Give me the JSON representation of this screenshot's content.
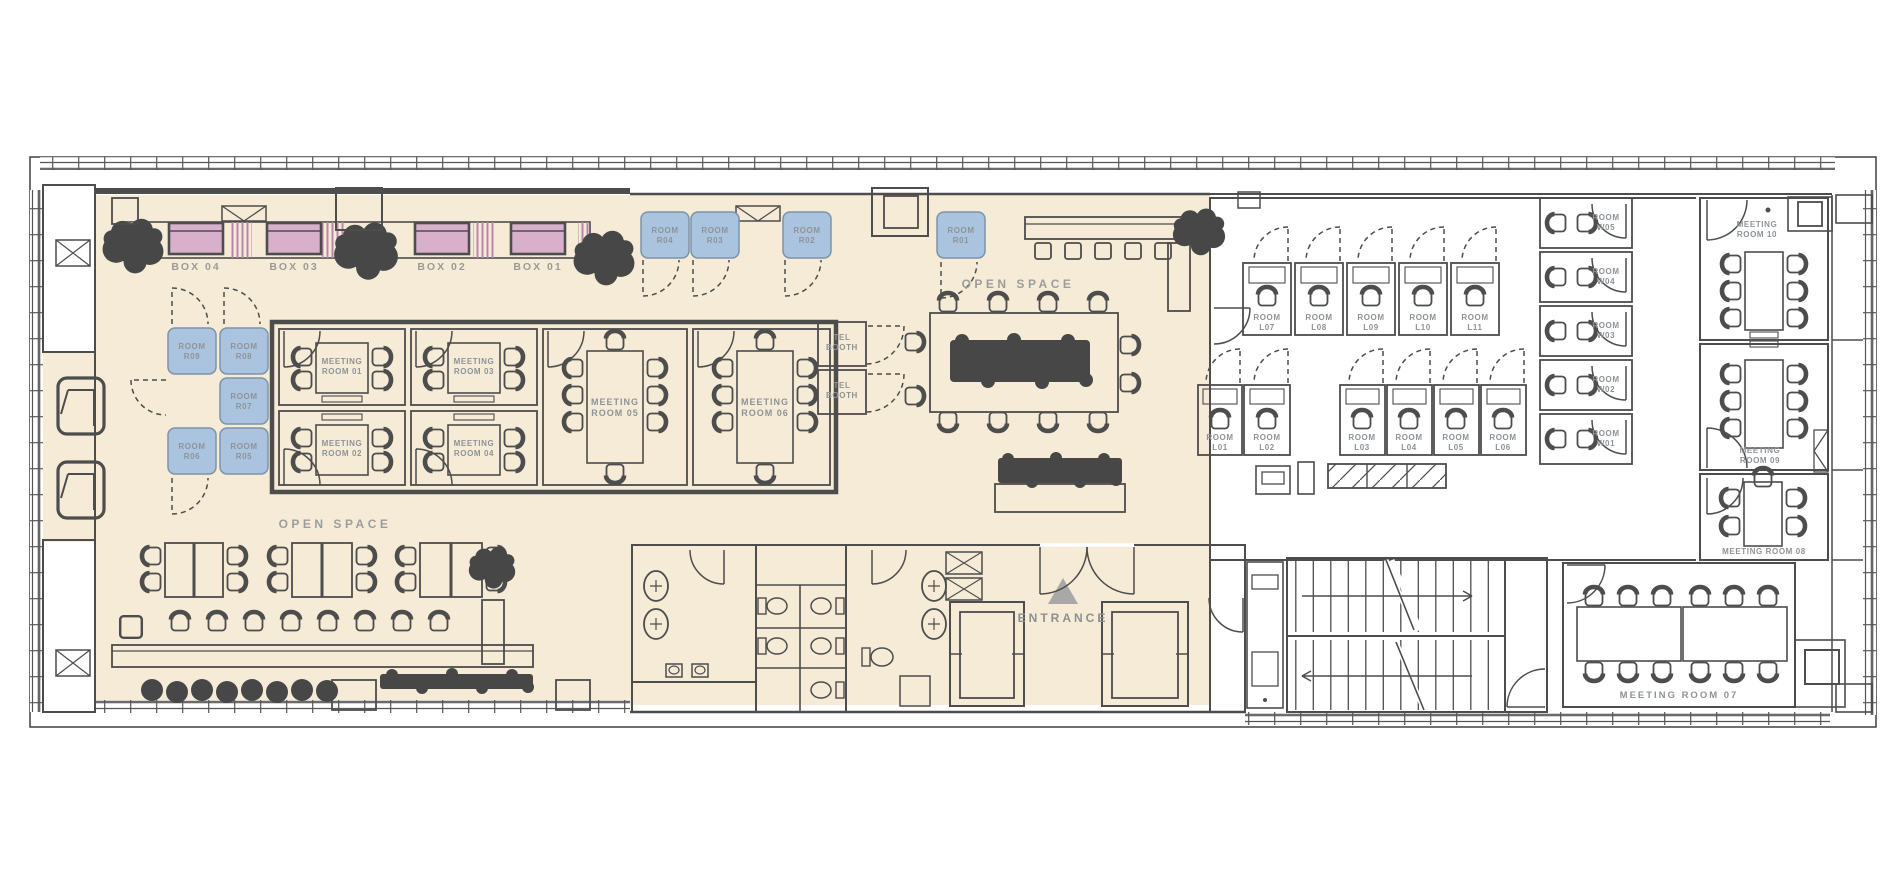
{
  "colors": {
    "floor_beige": "#f5ebd7",
    "room_blue": "#aac4e0",
    "room_blue_light": "#c6d8ec",
    "box_pink": "#d8b0cb",
    "box_pink_stripe": "#bb85ab",
    "zone_gray": "#e4e3e1",
    "booth_gray": "#e7e6e3",
    "wall": "#4d4d4d",
    "furniture": "#4a4a4a",
    "label_gray": "#9a9a9a",
    "entrance_marker": "#a8a8a8"
  },
  "boxes": [
    "BOX 04",
    "BOX 03",
    "BOX 02",
    "BOX 01"
  ],
  "open_space": {
    "center": "OPEN SPACE",
    "lounge": "OPEN SPACE"
  },
  "entrance": {
    "label": "ENTRANCE"
  },
  "tel_booths": [
    [
      "TEL",
      "BOOTH"
    ],
    [
      "TEL",
      "BOOTH"
    ]
  ],
  "rooms_r": [
    [
      "ROOM",
      "R01"
    ],
    [
      "ROOM",
      "R02"
    ],
    [
      "ROOM",
      "R03"
    ],
    [
      "ROOM",
      "R04"
    ],
    [
      "ROOM",
      "R05"
    ],
    [
      "ROOM",
      "R06"
    ],
    [
      "ROOM",
      "R07"
    ],
    [
      "ROOM",
      "R08"
    ],
    [
      "ROOM",
      "R09"
    ]
  ],
  "rooms_l": [
    [
      "ROOM",
      "L01"
    ],
    [
      "ROOM",
      "L02"
    ],
    [
      "ROOM",
      "L03"
    ],
    [
      "ROOM",
      "L04"
    ],
    [
      "ROOM",
      "L05"
    ],
    [
      "ROOM",
      "L06"
    ],
    [
      "ROOM",
      "L07"
    ],
    [
      "ROOM",
      "L08"
    ],
    [
      "ROOM",
      "L09"
    ],
    [
      "ROOM",
      "L10"
    ],
    [
      "ROOM",
      "L11"
    ]
  ],
  "rooms_w": [
    [
      "ROOM",
      "W01"
    ],
    [
      "ROOM",
      "W02"
    ],
    [
      "ROOM",
      "W03"
    ],
    [
      "ROOM",
      "W04"
    ],
    [
      "ROOM",
      "W05"
    ]
  ],
  "meeting_rooms": {
    "m01": [
      "MEETING",
      "ROOM 01"
    ],
    "m02": [
      "MEETING",
      "ROOM 02"
    ],
    "m03": [
      "MEETING",
      "ROOM 03"
    ],
    "m04": [
      "MEETING",
      "ROOM 04"
    ],
    "m05": [
      "MEETING",
      "ROOM 05"
    ],
    "m06": [
      "MEETING",
      "ROOM 06"
    ],
    "m07": "MEETING ROOM 07",
    "m08": "MEETING ROOM 08",
    "m09": [
      "MEETING",
      "ROOM 09"
    ],
    "m10": [
      "MEETING",
      "ROOM 10"
    ]
  }
}
